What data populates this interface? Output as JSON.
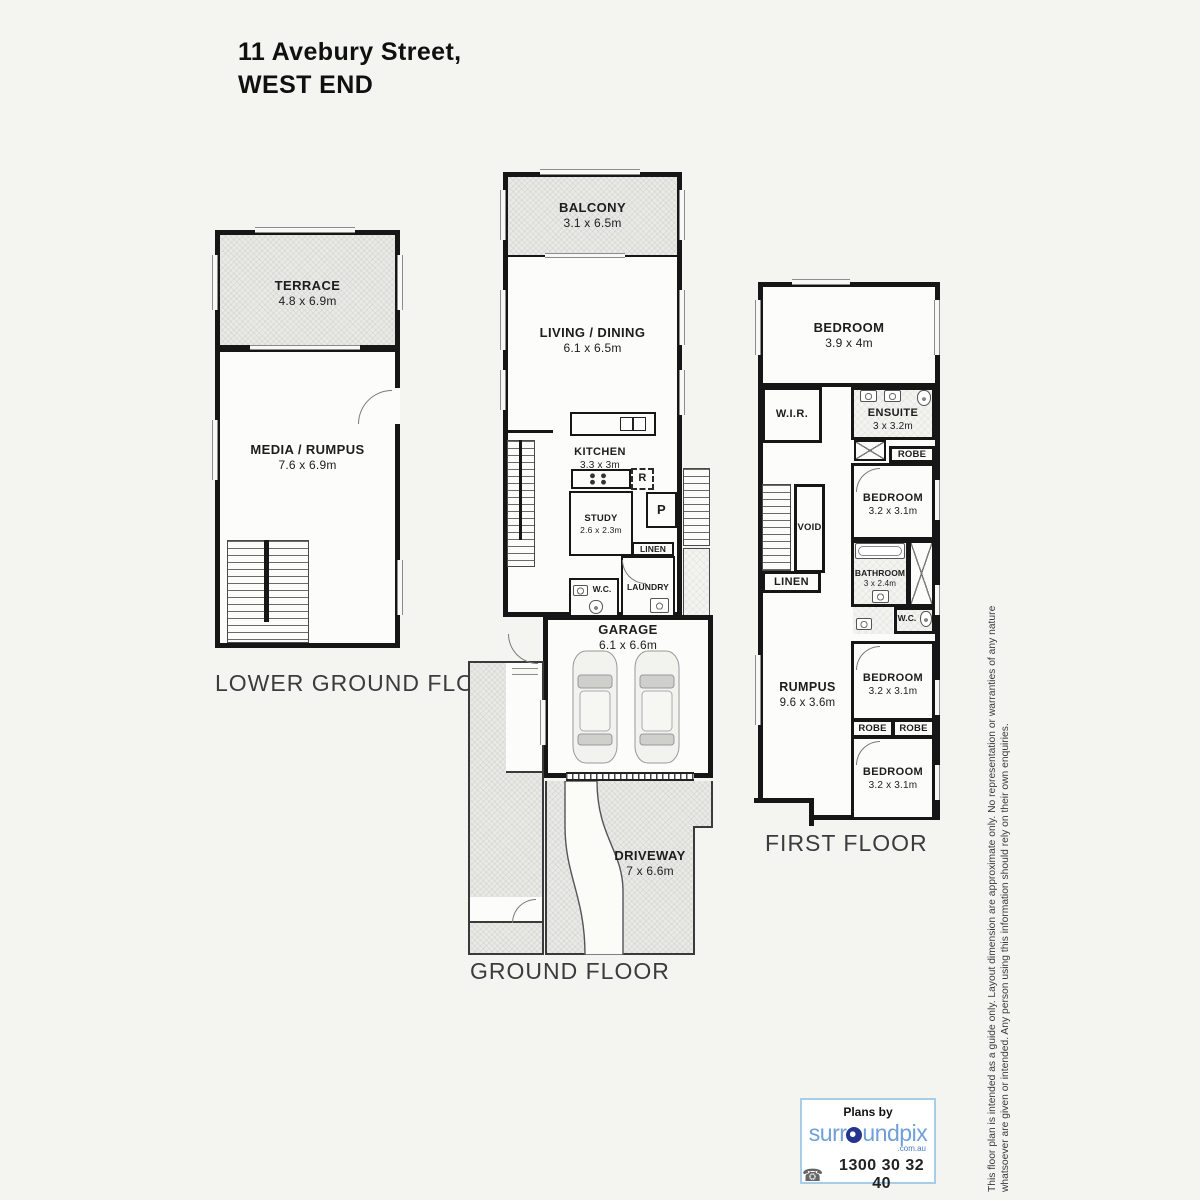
{
  "title": {
    "line1": "11 Avebury Street,",
    "line2": "WEST END"
  },
  "floors": {
    "lower_ground": {
      "label": "LOWER GROUND FLOOR",
      "rooms": {
        "terrace": {
          "name": "TERRACE",
          "dims": "4.8 x 6.9m"
        },
        "media_rumpus": {
          "name": "MEDIA / RUMPUS",
          "dims": "7.6 x 6.9m"
        }
      }
    },
    "ground": {
      "label": "GROUND FLOOR",
      "rooms": {
        "balcony": {
          "name": "BALCONY",
          "dims": "3.1 x 6.5m"
        },
        "living_dining": {
          "name": "LIVING / DINING",
          "dims": "6.1 x 6.5m"
        },
        "kitchen": {
          "name": "KITCHEN",
          "dims": "3.3 x 3m"
        },
        "fridge": {
          "name": "R"
        },
        "pantry": {
          "name": "P"
        },
        "study": {
          "name": "STUDY",
          "dims": "2.6 x 2.3m"
        },
        "linen": {
          "name": "LINEN"
        },
        "wc": {
          "name": "W.C."
        },
        "laundry": {
          "name": "LAUNDRY"
        },
        "garage": {
          "name": "GARAGE",
          "dims": "6.1 x 6.6m"
        },
        "driveway": {
          "name": "DRIVEWAY",
          "dims": "7 x 6.6m"
        }
      }
    },
    "first": {
      "label": "FIRST FLOOR",
      "rooms": {
        "bedroom1": {
          "name": "BEDROOM",
          "dims": "3.9 x 4m"
        },
        "wir": {
          "name": "W.I.R."
        },
        "ensuite": {
          "name": "ENSUITE",
          "dims": "3 x 3.2m"
        },
        "robe1": {
          "name": "ROBE"
        },
        "bedroom2": {
          "name": "BEDROOM",
          "dims": "3.2 x 3.1m"
        },
        "void": {
          "name": "VOID"
        },
        "linen": {
          "name": "LINEN"
        },
        "bathroom": {
          "name": "BATHROOM",
          "dims": "3 x 2.4m"
        },
        "wc": {
          "name": "W.C."
        },
        "rumpus": {
          "name": "RUMPUS",
          "dims": "9.6 x 3.6m"
        },
        "bedroom3": {
          "name": "BEDROOM",
          "dims": "3.2 x 3.1m"
        },
        "robe2": {
          "name": "ROBE"
        },
        "robe3": {
          "name": "ROBE"
        },
        "bedroom4": {
          "name": "BEDROOM",
          "dims": "3.2 x 3.1m"
        }
      }
    }
  },
  "branding": {
    "plans_by": "Plans by",
    "company_part1": "surr",
    "company_part2": "undpix",
    "domain": ".com.au",
    "phone": "1300 30 32 40",
    "brand_blue": "#6f9fd8",
    "brand_navy": "#25348c",
    "border_blue": "#a6cdea"
  },
  "disclaimer": {
    "line1": "This floor plan is intended as a guide only. Layout dimension are approximate only. No representation or warranties of any nature",
    "line2": "whatsoever are given or intended. Any person using this information should rely on their own enquiries."
  }
}
